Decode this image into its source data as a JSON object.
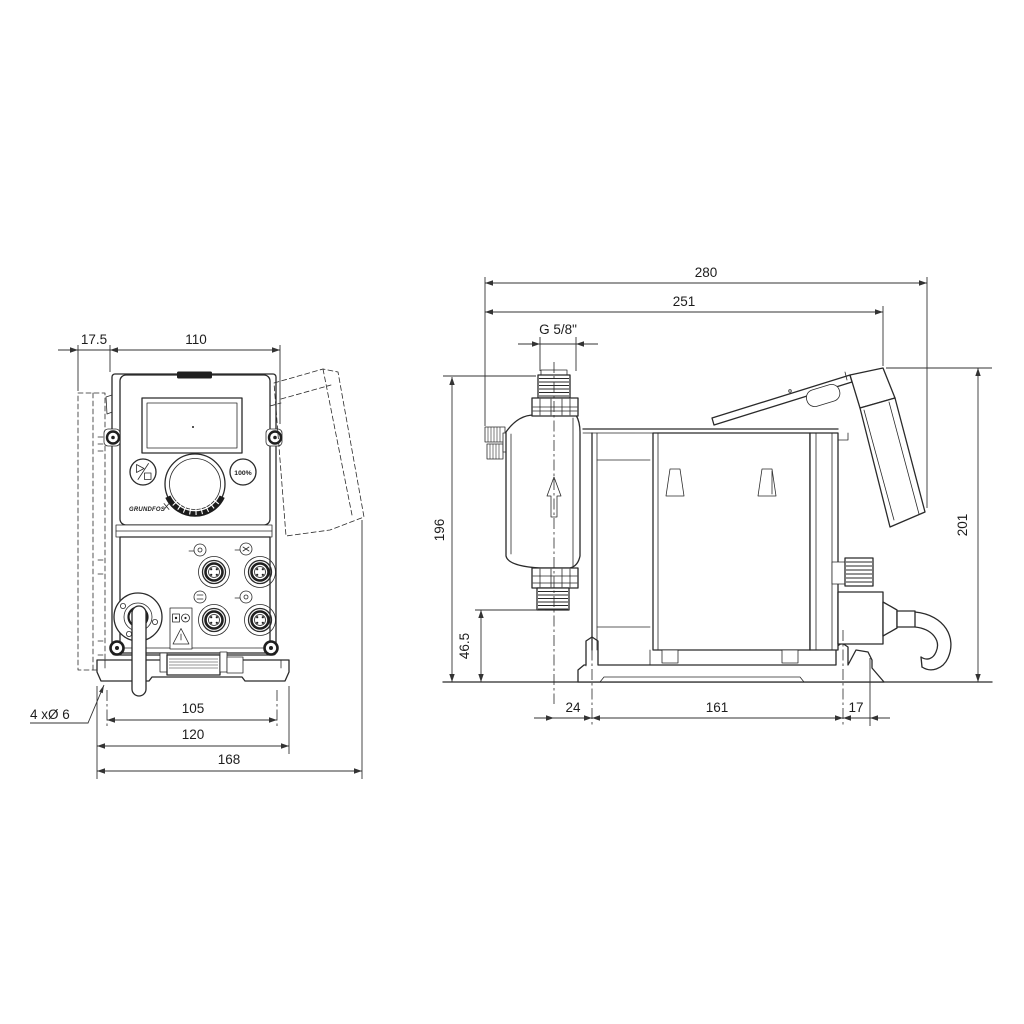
{
  "front_view": {
    "dims": {
      "wall_plate_offset": "17.5",
      "body_width": "110",
      "hole_spacing": "105",
      "bracket_width": "120",
      "overall_width": "168"
    },
    "mounting_holes_label": "4 xØ 6",
    "panel": {
      "capacity_button": "100%",
      "logo": "GRUNDFOS"
    }
  },
  "side_view": {
    "dims": {
      "overall_depth": "280",
      "depth_to_cover_edge": "251",
      "connection_thread": "G 5/8\"",
      "connection_height": "196",
      "outlet_valve_height": "46.5",
      "overall_height": "201",
      "hole_to_valve_offset": "24",
      "hole_spacing": "161",
      "rear_overhang": "17"
    }
  },
  "colors": {
    "line": "#2a2a2a",
    "dim": "#333333",
    "background": "#ffffff"
  }
}
